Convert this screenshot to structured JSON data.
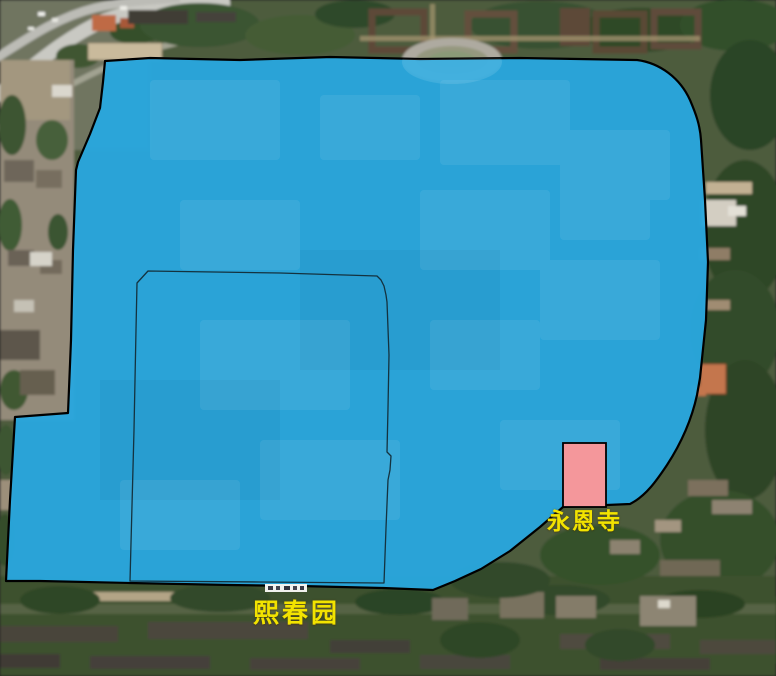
{
  "map": {
    "type": "satellite-imagery-with-overlays",
    "labels": {
      "temple": "永恩寺",
      "garden": "熙春园"
    },
    "colors": {
      "campus_fill": "#29A7DE",
      "campus_border": "#000000",
      "inner_boundary": "#14323F",
      "temple_fill": "#F4979B",
      "temple_border": "#000000",
      "label_color": "#F2E300"
    }
  }
}
